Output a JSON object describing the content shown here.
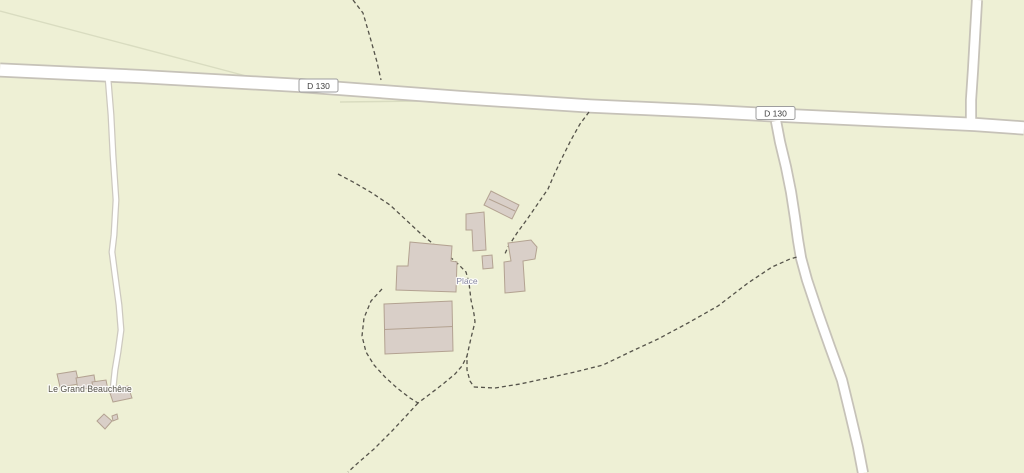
{
  "map": {
    "type": "openstreetmap-style rural map view",
    "labels": {
      "road_ref": "D 130",
      "place": "Place",
      "hamlet": "Le Grand Beauchêne"
    },
    "colors": {
      "background": "#eef0d5",
      "field_boundary": "#d9dcc0",
      "road_fill": "#ffffff",
      "road_casing": "#c6c2b8",
      "track_casing": "#cdc9bf",
      "footpath": "#55534a",
      "building_fill": "#d9cfc8",
      "building_stroke": "#b3a291",
      "badge_fill": "#ffffff",
      "badge_border": "#9e9e9e",
      "badge_text": "#404040",
      "place_text": "#8888a3",
      "hamlet_text": "#59564c"
    }
  }
}
